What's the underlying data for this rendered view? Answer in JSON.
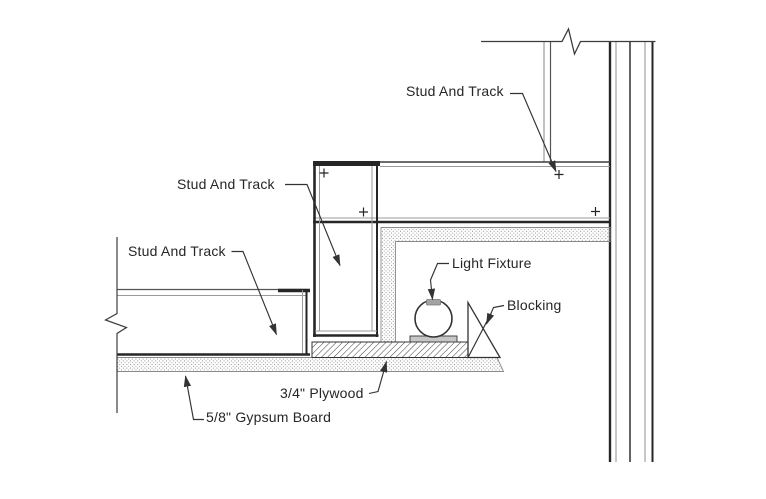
{
  "drawing": {
    "labels": {
      "stud_and_track": "Stud And Track",
      "light_fixture": "Light Fixture",
      "blocking": "Blocking",
      "plywood": "3/4\" Plywood",
      "gypsum_board": "5/8\" Gypsum Board"
    },
    "colors": {
      "background": "#ffffff",
      "text": "#262626",
      "line-dark": "#262626",
      "line-gray": "#8f8f8f"
    }
  }
}
